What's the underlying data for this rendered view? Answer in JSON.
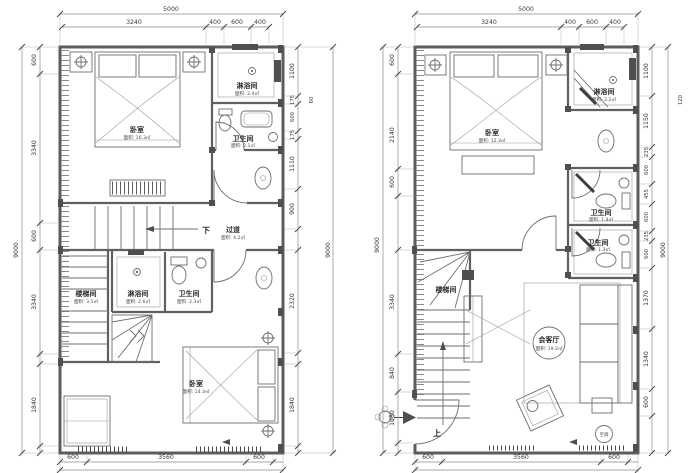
{
  "drawing": {
    "background": "#ffffff",
    "line_color": "#5c5c5c",
    "dim_text_color": "#3a3a3a"
  },
  "left_plan": {
    "dims": {
      "top_total": "5000",
      "top": [
        "3240",
        "400",
        "600",
        "400"
      ],
      "left_total": "9000",
      "left": [
        "600",
        "3340",
        "600",
        "3340",
        "1840"
      ],
      "right": [
        "1100",
        "175",
        "600",
        "175",
        "1110",
        "900",
        "2320",
        "1840"
      ],
      "right_small": "60",
      "right_total": "9000",
      "bottom": [
        "600",
        "3560",
        "600"
      ]
    },
    "labels": {
      "bedroom_top": {
        "name": "卧室",
        "area": "面积: 16.3㎡"
      },
      "shower_top": {
        "name": "淋浴间",
        "area": "面积: 2.4㎡"
      },
      "wc_top": {
        "name": "卫生间",
        "area": "面积: 2.1㎡"
      },
      "down": "下",
      "corridor": {
        "name": "过道",
        "area": "面积: 4.2㎡"
      },
      "stairwell": {
        "name": "楼梯间",
        "area": "面积: 3.1㎡"
      },
      "shower_bottom": {
        "name": "淋浴间",
        "area": "面积: 2.6㎡"
      },
      "wc_bottom": {
        "name": "卫生间",
        "area": "面积: 2.3㎡"
      },
      "bedroom_bottom": {
        "name": "卧室",
        "area": "面积: 14.3㎡"
      }
    }
  },
  "right_plan": {
    "dims": {
      "top_total": "5000",
      "top": [
        "3240",
        "400",
        "600",
        "400"
      ],
      "left_total": "9000",
      "left": [
        "600",
        "2140",
        "600",
        "3340",
        "840",
        "1080"
      ],
      "right": [
        "1100",
        "1150",
        "235",
        "600",
        "455",
        "600",
        "235",
        "600",
        "1370",
        "1340",
        "600"
      ],
      "right_small": "120",
      "right_total": "9000",
      "bottom": [
        "600",
        "3560",
        "600"
      ]
    },
    "labels": {
      "bedroom": {
        "name": "卧室",
        "area": "面积: 12.3㎡"
      },
      "shower": {
        "name": "淋浴间",
        "area": "面积: 2.2㎡"
      },
      "wc1": {
        "name": "卫生间",
        "area": "面积: 1.4㎡"
      },
      "wc2": {
        "name": "卫生间",
        "area": "面积: 1.3㎡"
      },
      "stairwell": {
        "name": "楼梯间"
      },
      "up": "上",
      "living": {
        "name": "会客厅",
        "area": "面积: 19.2㎡"
      },
      "ac_badge": "空调"
    }
  }
}
